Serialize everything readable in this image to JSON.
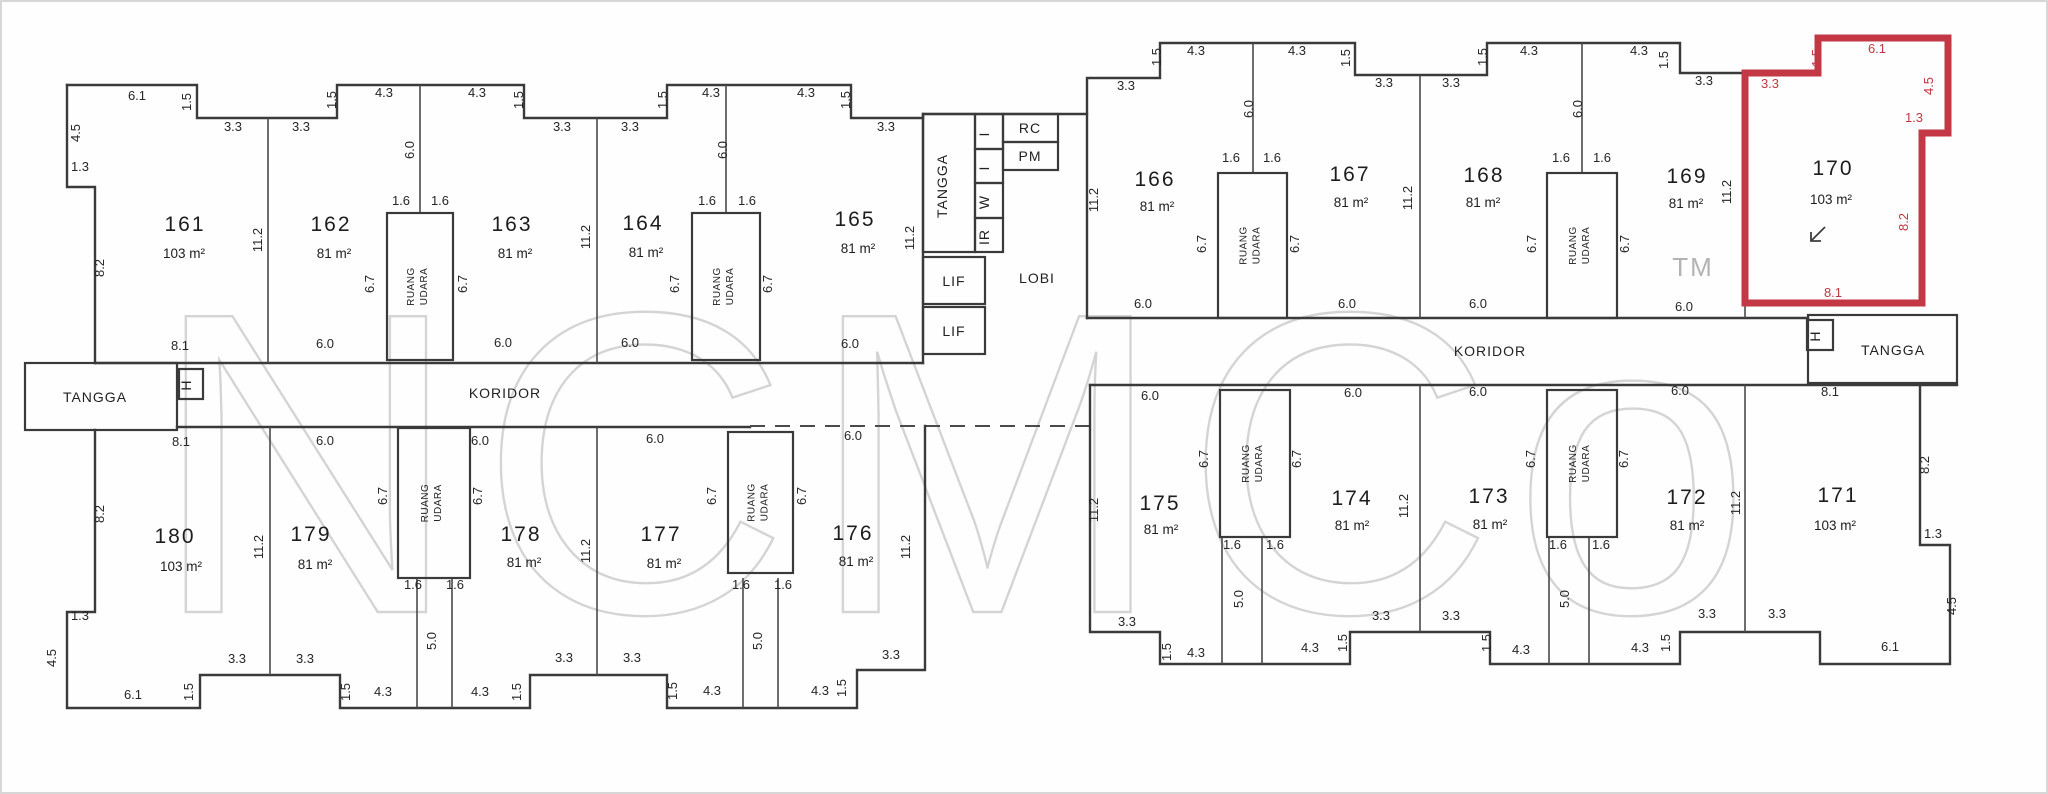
{
  "meta": {
    "type": "floor-plan-scan",
    "highlighted_unit": "170"
  },
  "colors": {
    "wall": "#3a3a3a",
    "highlight": "#c43744",
    "dim_text": "#262626",
    "watermark": "#b3b3b3"
  },
  "watermark": {
    "text": "NCMCo",
    "tm": "TM",
    "tm_x": 1693,
    "tm_y": 276
  },
  "rooms": [
    {
      "num": "161",
      "area": "103 m²",
      "nx": 185,
      "ny": 231,
      "ax": 184,
      "ay": 258
    },
    {
      "num": "162",
      "area": "81 m²",
      "nx": 331,
      "ny": 231,
      "ax": 334,
      "ay": 258
    },
    {
      "num": "163",
      "area": "81 m²",
      "nx": 512,
      "ny": 231,
      "ax": 515,
      "ay": 258
    },
    {
      "num": "164",
      "area": "81 m²",
      "nx": 643,
      "ny": 230,
      "ax": 646,
      "ay": 257
    },
    {
      "num": "165",
      "area": "81 m²",
      "nx": 855,
      "ny": 226,
      "ax": 858,
      "ay": 253
    },
    {
      "num": "166",
      "area": "81 m²",
      "nx": 1155,
      "ny": 186,
      "ax": 1157,
      "ay": 211
    },
    {
      "num": "167",
      "area": "81 m²",
      "nx": 1350,
      "ny": 181,
      "ax": 1351,
      "ay": 207
    },
    {
      "num": "168",
      "area": "81 m²",
      "nx": 1484,
      "ny": 182,
      "ax": 1483,
      "ay": 207
    },
    {
      "num": "169",
      "area": "81 m²",
      "nx": 1687,
      "ny": 183,
      "ax": 1686,
      "ay": 208
    },
    {
      "num": "170",
      "area": "103 m²",
      "nx": 1833,
      "ny": 175,
      "ax": 1831,
      "ay": 204
    },
    {
      "num": "171",
      "area": "103 m²",
      "nx": 1838,
      "ny": 502,
      "ax": 1835,
      "ay": 530
    },
    {
      "num": "172",
      "area": "81 m²",
      "nx": 1687,
      "ny": 504,
      "ax": 1687,
      "ay": 530
    },
    {
      "num": "173",
      "area": "81 m²",
      "nx": 1489,
      "ny": 503,
      "ax": 1490,
      "ay": 529
    },
    {
      "num": "174",
      "area": "81 m²",
      "nx": 1352,
      "ny": 505,
      "ax": 1352,
      "ay": 530
    },
    {
      "num": "175",
      "area": "81 m²",
      "nx": 1160,
      "ny": 510,
      "ax": 1161,
      "ay": 534
    },
    {
      "num": "176",
      "area": "81 m²",
      "nx": 853,
      "ny": 540,
      "ax": 856,
      "ay": 566
    },
    {
      "num": "177",
      "area": "81 m²",
      "nx": 661,
      "ny": 541,
      "ax": 664,
      "ay": 568
    },
    {
      "num": "178",
      "area": "81 m²",
      "nx": 521,
      "ny": 541,
      "ax": 524,
      "ay": 567
    },
    {
      "num": "179",
      "area": "81 m²",
      "nx": 311,
      "ny": 541,
      "ax": 315,
      "ay": 569
    },
    {
      "num": "180",
      "area": "103 m²",
      "nx": 175,
      "ny": 543,
      "ax": 181,
      "ay": 571
    }
  ],
  "labels": [
    {
      "key": "koridor-left",
      "text": "KORIDOR",
      "x": 505,
      "y": 398,
      "fs": 14
    },
    {
      "key": "koridor-right",
      "text": "KORIDOR",
      "x": 1490,
      "y": 356,
      "fs": 14
    },
    {
      "key": "tangga-left",
      "text": "TANGGA",
      "x": 95,
      "y": 402,
      "fs": 13.5,
      "box": [
        25,
        363,
        152,
        67
      ]
    },
    {
      "key": "tangga-right",
      "text": "TANGGA",
      "x": 1893,
      "y": 355,
      "fs": 13.5,
      "box": [
        1808,
        315,
        149,
        68
      ]
    },
    {
      "key": "tangga-core",
      "text": "TANGGA",
      "x": 947,
      "y": 186,
      "fs": 12.5,
      "rot": 1,
      "box": [
        923,
        114,
        52,
        138
      ]
    },
    {
      "key": "lif-1",
      "text": "LIF",
      "x": 954,
      "y": 286,
      "fs": 12.5,
      "box": [
        923,
        257,
        62,
        47
      ]
    },
    {
      "key": "lif-2",
      "text": "LIF",
      "x": 954,
      "y": 336,
      "fs": 12.5,
      "box": [
        923,
        307,
        62,
        47
      ]
    },
    {
      "key": "lobi",
      "text": "LOBI",
      "x": 1037,
      "y": 283,
      "fs": 13.5
    },
    {
      "key": "room-rc",
      "text": "RC",
      "x": 1030,
      "y": 133,
      "fs": 10.5,
      "box": [
        1003,
        114,
        55,
        28
      ]
    },
    {
      "key": "room-pm",
      "text": "PM",
      "x": 1030,
      "y": 161,
      "fs": 10.5,
      "box": [
        1003,
        142,
        55,
        28
      ]
    },
    {
      "key": "svc-1",
      "text": "I",
      "x": 989,
      "y": 134,
      "fs": 9,
      "rot": 1,
      "box": [
        975,
        114,
        28,
        35
      ]
    },
    {
      "key": "svc-2",
      "text": "I",
      "x": 989,
      "y": 168,
      "fs": 9,
      "rot": 1,
      "box": [
        975,
        149,
        28,
        34
      ]
    },
    {
      "key": "svc-3",
      "text": "W",
      "x": 989,
      "y": 202,
      "fs": 9,
      "rot": 1,
      "box": [
        975,
        183,
        28,
        35
      ]
    },
    {
      "key": "svc-4",
      "text": "IR",
      "x": 989,
      "y": 237,
      "fs": 9,
      "rot": 1,
      "box": [
        975,
        218,
        28,
        34
      ]
    },
    {
      "key": "hydrant-left",
      "text": "H",
      "x": 191,
      "y": 385,
      "fs": 8,
      "rot": 1,
      "box": [
        179,
        369,
        24,
        30
      ]
    },
    {
      "key": "hydrant-right",
      "text": "H",
      "x": 1820,
      "y": 336,
      "fs": 8,
      "rot": 1,
      "box": [
        1807,
        320,
        26,
        30
      ]
    }
  ],
  "shafts": [
    {
      "w1": "RUANG",
      "w2": "UDARA",
      "box": [
        387,
        213,
        66,
        147
      ]
    },
    {
      "w1": "RUANG",
      "w2": "UDARA",
      "box": [
        692,
        213,
        68,
        147
      ]
    },
    {
      "w1": "RUANG",
      "w2": "UDARA",
      "box": [
        1218,
        173,
        69,
        145
      ]
    },
    {
      "w1": "RUANG",
      "w2": "UDARA",
      "box": [
        1547,
        173,
        70,
        145
      ]
    },
    {
      "w1": "RUANG",
      "w2": "UDARA",
      "box": [
        398,
        428,
        72,
        150
      ]
    },
    {
      "w1": "RUANG",
      "w2": "UDARA",
      "box": [
        728,
        432,
        65,
        141
      ]
    },
    {
      "w1": "RUANG",
      "w2": "UDARA",
      "box": [
        1220,
        390,
        70,
        147
      ]
    },
    {
      "w1": "RUANG",
      "w2": "UDARA",
      "box": [
        1547,
        390,
        70,
        147
      ]
    }
  ],
  "dims": [
    [
      "6.1",
      137,
      100
    ],
    [
      "1.5",
      191,
      102,
      1
    ],
    [
      "3.3",
      233,
      131
    ],
    [
      "3.3",
      301,
      131
    ],
    [
      "1.5",
      336,
      100,
      1
    ],
    [
      "4.3",
      384,
      97
    ],
    [
      "4.3",
      477,
      97
    ],
    [
      "1.5",
      523,
      100,
      1
    ],
    [
      "3.3",
      562,
      131
    ],
    [
      "3.3",
      630,
      131
    ],
    [
      "1.5",
      667,
      100,
      1
    ],
    [
      "4.3",
      711,
      97
    ],
    [
      "4.3",
      806,
      97
    ],
    [
      "1.5",
      850,
      100,
      1
    ],
    [
      "3.3",
      886,
      131
    ],
    [
      "3.3",
      1126,
      90
    ],
    [
      "1.5",
      1161,
      57,
      1
    ],
    [
      "4.3",
      1196,
      55
    ],
    [
      "4.3",
      1297,
      55
    ],
    [
      "1.5",
      1350,
      58,
      1
    ],
    [
      "3.3",
      1384,
      87
    ],
    [
      "3.3",
      1451,
      87
    ],
    [
      "1.5",
      1487,
      57,
      1
    ],
    [
      "4.3",
      1529,
      55
    ],
    [
      "4.3",
      1639,
      55
    ],
    [
      "1.5",
      1668,
      60,
      1
    ],
    [
      "3.3",
      1704,
      85
    ],
    [
      "3.3",
      1770,
      88,
      0,
      1
    ],
    [
      "1.5",
      1821,
      58,
      1,
      1
    ],
    [
      "6.1",
      1877,
      53,
      0,
      1
    ],
    [
      "4.5",
      1933,
      86,
      1,
      1
    ],
    [
      "1.3",
      1914,
      122,
      0,
      1
    ],
    [
      "8.2",
      1908,
      222,
      1,
      1
    ],
    [
      "8.1",
      1833,
      297,
      0,
      1
    ],
    [
      "4.5",
      80,
      133,
      1
    ],
    [
      "1.3",
      80,
      171
    ],
    [
      "8.2",
      104,
      268,
      1
    ],
    [
      "8.2",
      104,
      514,
      1
    ],
    [
      "1.3",
      80,
      620
    ],
    [
      "4.5",
      56,
      658,
      1
    ],
    [
      "8.2",
      1929,
      465,
      1
    ],
    [
      "1.3",
      1933,
      538
    ],
    [
      "4.5",
      1956,
      606,
      1
    ],
    [
      "8.1",
      180,
      350
    ],
    [
      "6.0",
      325,
      348
    ],
    [
      "6.0",
      503,
      347
    ],
    [
      "6.0",
      630,
      347
    ],
    [
      "6.0",
      850,
      348
    ],
    [
      "8.1",
      181,
      446
    ],
    [
      "6.0",
      325,
      445
    ],
    [
      "6.0",
      480,
      445
    ],
    [
      "6.0",
      655,
      443
    ],
    [
      "6.0",
      853,
      440
    ],
    [
      "6.0",
      1143,
      308
    ],
    [
      "6.0",
      1347,
      308
    ],
    [
      "6.0",
      1478,
      308
    ],
    [
      "6.0",
      1684,
      311
    ],
    [
      "6.0",
      1150,
      400
    ],
    [
      "6.0",
      1353,
      397
    ],
    [
      "6.0",
      1478,
      396
    ],
    [
      "6.0",
      1680,
      395
    ],
    [
      "8.1",
      1830,
      396
    ],
    [
      "11.2",
      262,
      240,
      1
    ],
    [
      "11.2",
      590,
      237,
      1
    ],
    [
      "11.2",
      914,
      238,
      1
    ],
    [
      "11.2",
      1098,
      200,
      1
    ],
    [
      "11.2",
      1412,
      198,
      1
    ],
    [
      "11.2",
      1731,
      192,
      1
    ],
    [
      "11.2",
      263,
      547,
      1
    ],
    [
      "11.2",
      590,
      551,
      1
    ],
    [
      "11.2",
      910,
      547,
      1
    ],
    [
      "11.2",
      1098,
      510,
      1
    ],
    [
      "11.2",
      1408,
      506,
      1
    ],
    [
      "11.2",
      1740,
      503,
      1
    ],
    [
      "6.0",
      414,
      150,
      1
    ],
    [
      "1.6",
      401,
      205
    ],
    [
      "1.6",
      440,
      205
    ],
    [
      "6.7",
      374,
      284,
      1
    ],
    [
      "6.7",
      467,
      284,
      1
    ],
    [
      "6.0",
      727,
      150,
      1
    ],
    [
      "1.6",
      707,
      205
    ],
    [
      "1.6",
      747,
      205
    ],
    [
      "6.7",
      679,
      284,
      1
    ],
    [
      "6.7",
      772,
      284,
      1
    ],
    [
      "6.0",
      1253,
      109,
      1
    ],
    [
      "1.6",
      1231,
      162
    ],
    [
      "1.6",
      1272,
      162
    ],
    [
      "6.7",
      1206,
      244,
      1
    ],
    [
      "6.7",
      1299,
      244,
      1
    ],
    [
      "6.0",
      1582,
      109,
      1
    ],
    [
      "1.6",
      1561,
      162
    ],
    [
      "1.6",
      1602,
      162
    ],
    [
      "6.7",
      1536,
      244,
      1
    ],
    [
      "6.7",
      1629,
      244,
      1
    ],
    [
      "1.6",
      413,
      589
    ],
    [
      "1.6",
      455,
      589
    ],
    [
      "5.0",
      436,
      641,
      1
    ],
    [
      "6.7",
      387,
      496,
      1
    ],
    [
      "6.7",
      482,
      496,
      1
    ],
    [
      "1.6",
      741,
      589
    ],
    [
      "1.6",
      783,
      589
    ],
    [
      "5.0",
      762,
      641,
      1
    ],
    [
      "6.7",
      716,
      496,
      1
    ],
    [
      "6.7",
      806,
      496,
      1
    ],
    [
      "1.6",
      1232,
      549
    ],
    [
      "1.6",
      1275,
      549
    ],
    [
      "5.0",
      1243,
      599,
      1
    ],
    [
      "6.7",
      1208,
      459,
      1
    ],
    [
      "6.7",
      1301,
      459,
      1
    ],
    [
      "1.6",
      1558,
      549
    ],
    [
      "1.6",
      1601,
      549
    ],
    [
      "5.0",
      1569,
      599,
      1
    ],
    [
      "6.7",
      1535,
      459,
      1
    ],
    [
      "6.7",
      1628,
      459,
      1
    ],
    [
      "6.1",
      133,
      699
    ],
    [
      "1.5",
      193,
      692,
      1
    ],
    [
      "3.3",
      237,
      663
    ],
    [
      "3.3",
      305,
      663
    ],
    [
      "1.5",
      350,
      692,
      1
    ],
    [
      "4.3",
      383,
      696
    ],
    [
      "4.3",
      480,
      696
    ],
    [
      "1.5",
      521,
      692,
      1
    ],
    [
      "3.3",
      564,
      662
    ],
    [
      "3.3",
      632,
      662
    ],
    [
      "1.5",
      677,
      691,
      1
    ],
    [
      "4.3",
      712,
      695
    ],
    [
      "4.3",
      820,
      695
    ],
    [
      "1.5",
      846,
      688,
      1
    ],
    [
      "3.3",
      891,
      659
    ],
    [
      "3.3",
      1127,
      626
    ],
    [
      "1.5",
      1171,
      652,
      1
    ],
    [
      "4.3",
      1196,
      657
    ],
    [
      "4.3",
      1310,
      652
    ],
    [
      "1.5",
      1347,
      643,
      1
    ],
    [
      "3.3",
      1381,
      620
    ],
    [
      "3.3",
      1451,
      620
    ],
    [
      "1.5",
      1491,
      643,
      1
    ],
    [
      "4.3",
      1521,
      654
    ],
    [
      "4.3",
      1640,
      652
    ],
    [
      "1.5",
      1670,
      643,
      1
    ],
    [
      "3.3",
      1707,
      618
    ],
    [
      "3.3",
      1777,
      618
    ],
    [
      "6.1",
      1890,
      651
    ]
  ]
}
